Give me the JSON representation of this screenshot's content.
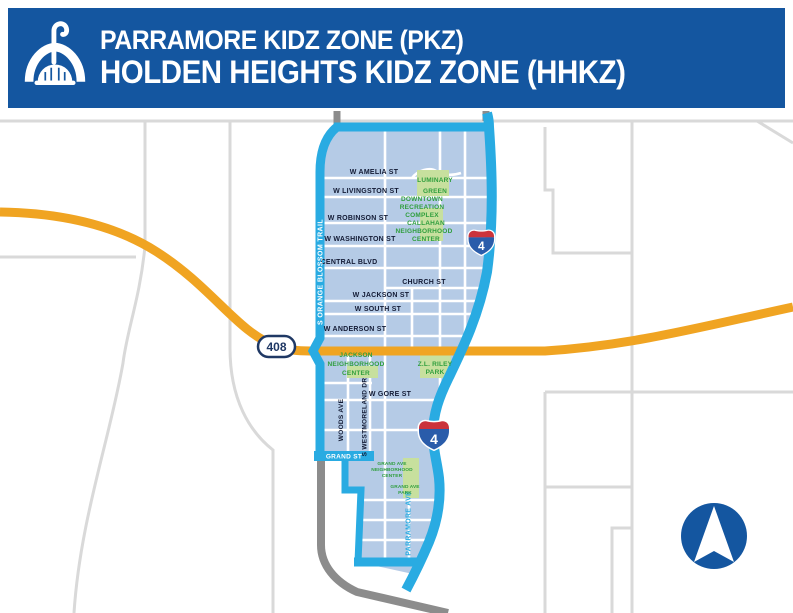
{
  "header": {
    "line1": "PARRAMORE KIDZ ZONE (PKZ)",
    "line2": "HOLDEN HEIGHTS KIDZ ZONE (HHKZ)",
    "logo": "city-fountain-icon",
    "background_color": "#1456a0",
    "text_color": "#ffffff"
  },
  "map": {
    "colors": {
      "zone_fill": "#b5cbe6",
      "zone_boundary": "#29abe2",
      "toll_road": "#f0a422",
      "minor_road": "#d9d9d9",
      "major_road_gray": "#8c8c8c",
      "place_green_text": "#2f9e3d",
      "place_green_patch": "#c7e09e",
      "shield_navy": "#1f3864",
      "interstate_red": "#cb333b",
      "interstate_blue": "#2a5caa",
      "compass_blue": "#1456a0"
    },
    "streets": {
      "horizontal": [
        "W AMELIA ST",
        "W LIVINGSTON ST",
        "W ROBINSON ST",
        "W WASHINGTON ST",
        "CENTRAL BLVD",
        "CHURCH ST",
        "W JACKSON ST",
        "W SOUTH ST",
        "W ANDERSON ST",
        "W GORE ST",
        "GRAND ST"
      ],
      "vertical": [
        "S ORANGE BLOSSOM TRAIL",
        "WOODS AVE",
        "S WESTMORELAND DR",
        "S PARRAMORE AVE"
      ]
    },
    "places": [
      {
        "name": "Luminary Green",
        "lines": [
          "LUMINARY",
          "GREEN"
        ]
      },
      {
        "name": "Downtown Recreation Complex",
        "lines": [
          "DOWNTOWN",
          "RECREATION",
          "COMPLEX"
        ]
      },
      {
        "name": "Callahan Neighborhood Center",
        "lines": [
          "CALLAHAN",
          "NEIGHBORHOOD",
          "CENTER"
        ]
      },
      {
        "name": "Jackson Neighborhood Center",
        "lines": [
          "JACKSON",
          "NEIGHBORHOOD",
          "CENTER"
        ]
      },
      {
        "name": "Z.L. Riley Park",
        "lines": [
          "Z.L. RILEY",
          "PARK"
        ]
      },
      {
        "name": "Grand Ave Neighborhood Center",
        "lines": [
          "GRAND AVE",
          "NEIGHBORHOOD",
          "CENTER"
        ]
      },
      {
        "name": "Grand Ave Park",
        "lines": [
          "GRAND AVE",
          "PARK"
        ]
      }
    ],
    "shields": {
      "toll": "408",
      "interstate": "4"
    },
    "compass": "north-arrow"
  }
}
